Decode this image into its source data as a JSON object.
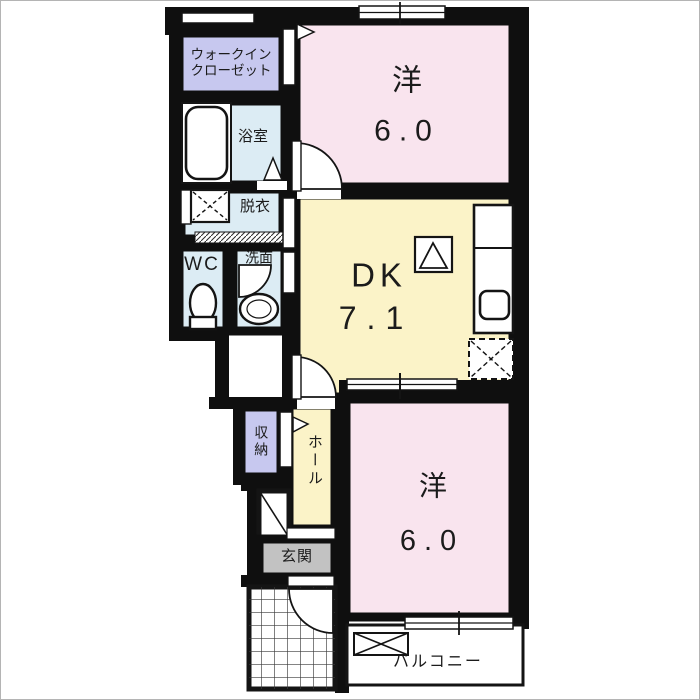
{
  "title": "1DK apartment floor plan",
  "colors": {
    "wall": "#0f0f0f",
    "room_pink": "#f9e4ee",
    "room_yellow": "#fbf3c8",
    "room_blue": "#dcecf4",
    "room_lavender": "#c7c8ef",
    "entrance_gray": "#c2c2c2"
  },
  "rooms": {
    "wic": {
      "label": "ウォークイン\nクローゼット"
    },
    "bath": {
      "label": "浴室"
    },
    "dressing": {
      "label": "脱衣"
    },
    "wc": {
      "label": "WC"
    },
    "washroom": {
      "label": "洗面"
    },
    "dk": {
      "label": "DK",
      "size": "7.1"
    },
    "bedroom_top": {
      "label": "洋",
      "size": "6.0"
    },
    "bedroom_bottom": {
      "label": "洋",
      "size": "6.0"
    },
    "hall": {
      "label": "ホール"
    },
    "storage": {
      "label": "収納"
    },
    "entrance": {
      "label": "玄関"
    },
    "balcony": {
      "label": "バルコニー"
    }
  },
  "icons": {
    "bathtub-icon": "rounded-rect",
    "toilet-icon": "ellipse-with-base",
    "washbasin-icon": "double-ellipse",
    "washing-machine-pan-icon": "box-with-dashed-x",
    "refrigerator-space-icon": "dashed-box-with-x",
    "cooktop-icon": "box-with-triangle",
    "kitchen-sink-icon": "rounded-square",
    "door-swing-icon": "quarter-arc",
    "door-direction-icon": "triangle",
    "window-icon": "double-line-bar",
    "porch-tile-icon": "grid",
    "balcony-equipment-box-icon": "box-with-x"
  }
}
